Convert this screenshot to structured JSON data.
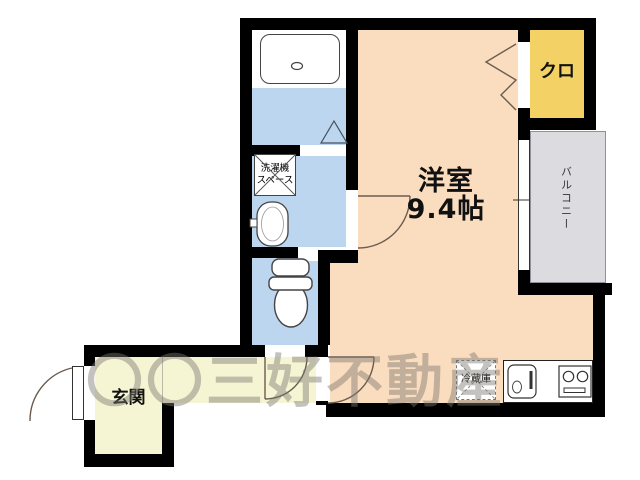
{
  "rooms": {
    "living": {
      "name": "洋室",
      "size": "9.4帖",
      "color": "#fadcbe"
    },
    "closet": {
      "label": "クロ",
      "color": "#f3d164"
    },
    "balcony": {
      "label": "バルコニー",
      "color": "#dcdce0"
    },
    "entrance": {
      "label": "玄関",
      "color": "#f6f5d3"
    },
    "bathroom": {
      "color": "#bcd6ef"
    },
    "washroom": {
      "color": "#bcd6ef"
    },
    "toilet": {
      "color": "#bcd6ef"
    }
  },
  "fixtures": {
    "washer_space": {
      "line1": "洗濯機",
      "line2": "スペース"
    },
    "fridge": {
      "label": "冷蔵庫"
    },
    "icons": [
      "bathtub",
      "bath-folding-door",
      "washbasin",
      "toilet",
      "kitchen-sink",
      "gas-stove",
      "sliding-window",
      "closet-folding-door",
      "door-swing-arc",
      "entrance-door"
    ]
  },
  "watermark": {
    "text": "〇〇三好不動産",
    "color": "rgba(125,119,113,0.45)"
  },
  "palette": {
    "wall": "#000000",
    "water": "#bcd6ef",
    "room": "#fadcbe",
    "closet": "#f3d164",
    "hall": "#f6f5d3",
    "balcony": "#dcdce0",
    "line": "#6b5c50",
    "watermark": "rgba(125,119,113,0.45)"
  }
}
